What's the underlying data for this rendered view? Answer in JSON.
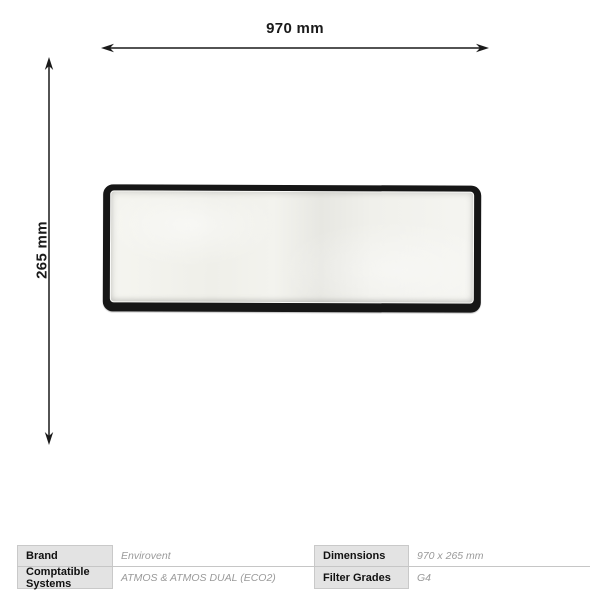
{
  "page": {
    "background": "#ffffff",
    "description": "Product dimension diagram of a rectangular panel filter with specification table"
  },
  "dimensions": {
    "width_label": "970 mm",
    "height_label": "265 mm"
  },
  "product": {
    "name": "panel-filter",
    "frame_color": "#161616",
    "pad_color": "#f2f2ed"
  },
  "spec_table": {
    "left": [
      {
        "label": "Brand",
        "value": "Envirovent"
      },
      {
        "label": "Comptatible Systems",
        "value": "ATMOS & ATMOS DUAL (ECO2)"
      }
    ],
    "right": [
      {
        "label": "Dimensions",
        "value": "970 x 265 mm"
      },
      {
        "label": "Filter Grades",
        "value": "G4"
      }
    ]
  },
  "colors": {
    "ink": "#1a1a1a",
    "value_text": "#9a9a9a",
    "label_bg": "#e3e3e3",
    "cell_border": "#c9c9c9",
    "separator": "#c6c6c6"
  }
}
